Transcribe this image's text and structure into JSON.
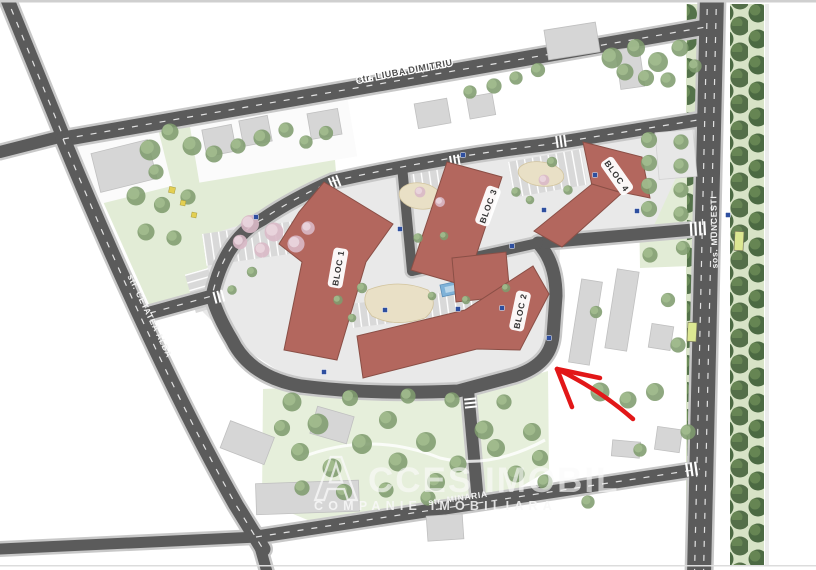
{
  "map": {
    "street_labels": {
      "top": "str. LIUBA DIMITRIU",
      "left": "str. CETATEA ALBA",
      "right": "sos. MUNCESTI",
      "bottom": "str. MINARIA"
    },
    "block_labels": [
      "BLOC 1",
      "BLOC 2",
      "BLOC 3",
      "BLOC 4"
    ],
    "watermark": {
      "logo_letter": "A",
      "brand": "CCES IMOBIL",
      "tagline": "COMPANIE IMOBILIARA"
    },
    "annotation": {
      "type": "location-arrow",
      "color": "#e21718"
    },
    "colors": {
      "road": "#5b5b5b",
      "road_edge": "#c8c8c8",
      "residential_block": "#b3675e",
      "residential_block_outline": "#8a4f46",
      "context_building": "#d6d6d6",
      "greenery": "#e2ecd6",
      "tree": "#809c6e",
      "tree_dark": "#54724a",
      "pink_tree": "#d9b9c6",
      "pavement": "#e9e9e9",
      "pool": "#7fb2d8",
      "sign_blue": "#2e4f9f",
      "bus_bay": "#dce792",
      "arrow_red": "#e21718"
    }
  }
}
